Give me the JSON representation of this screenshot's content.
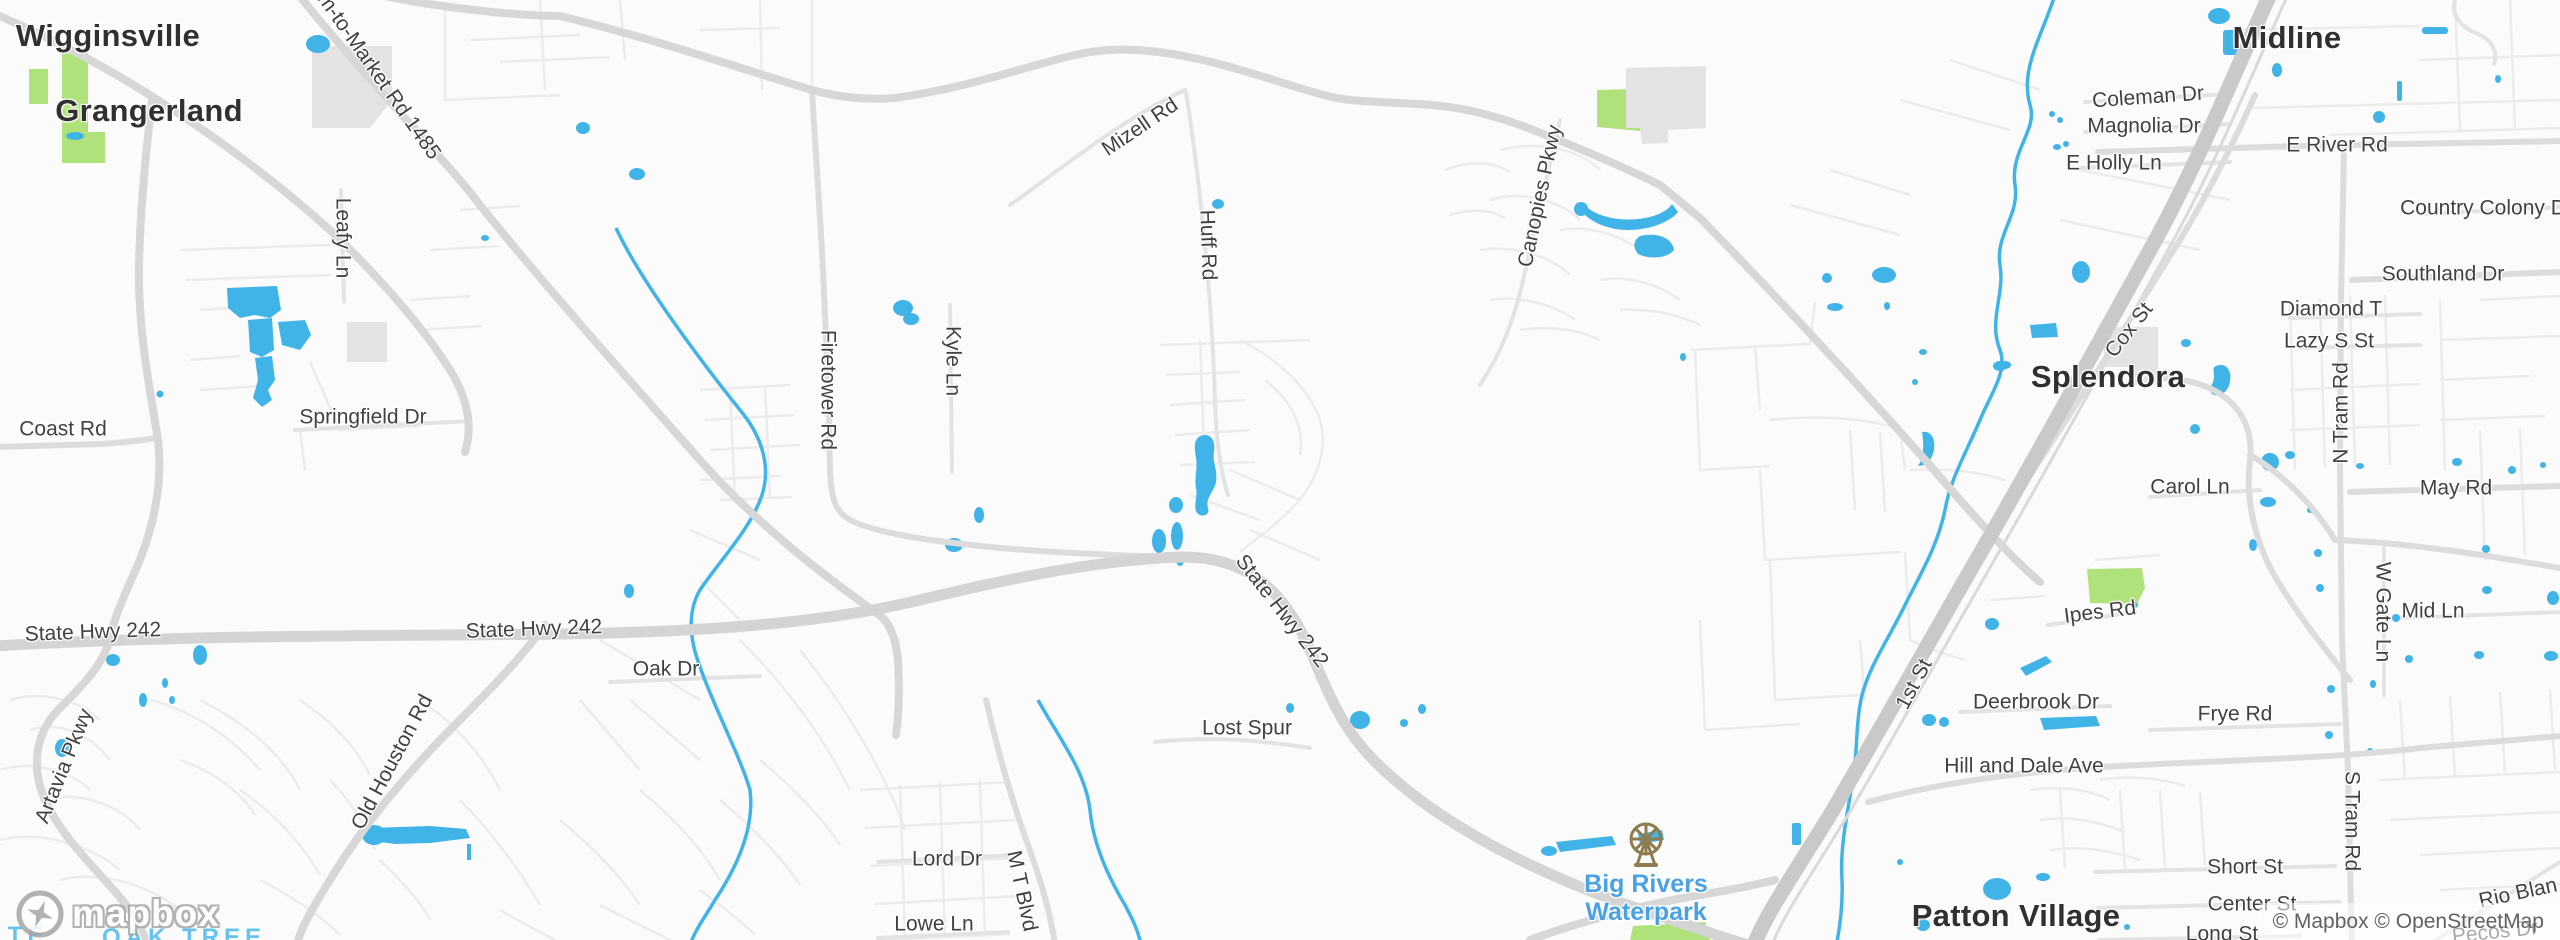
{
  "map": {
    "attribution": "© Mapbox © OpenStreetMap",
    "logo_text": "mapbox",
    "colors": {
      "background": "#fbfbfb",
      "water": "#41b4e7",
      "park_green": "#b0e27c",
      "building": "#e3e3e3",
      "road_major": "#d9d9d9",
      "road_highway": "#c9c9c9",
      "road_minor": "#e7e7e7",
      "town_label": "#303030",
      "road_label": "#414141",
      "poi_label": "#4aa1e4",
      "neighborhood_label": "#64c3f0",
      "attribution_text": "#616161"
    },
    "poi": {
      "line1": "Big Rivers",
      "line2": "Waterpark",
      "icon": "ferris-wheel-icon"
    },
    "labels": [
      {
        "text": "Wigginsville",
        "x": 108,
        "y": 36,
        "r": 0,
        "type": "city"
      },
      {
        "text": "Grangerland",
        "x": 149,
        "y": 111,
        "r": 0,
        "type": "city"
      },
      {
        "text": "Splendora",
        "x": 2108,
        "y": 377,
        "r": 0,
        "type": "city"
      },
      {
        "text": "Midline",
        "x": 2287,
        "y": 38,
        "r": 0,
        "type": "city"
      },
      {
        "text": "Patton Village",
        "x": 2016,
        "y": 916,
        "r": 0,
        "type": "city"
      },
      {
        "text": "Farm-to-Market Rd 1485",
        "x": 370,
        "y": 63,
        "r": 55,
        "type": "road"
      },
      {
        "text": "Coast Rd",
        "x": 63,
        "y": 429,
        "r": 0,
        "type": "road"
      },
      {
        "text": "State Hwy 242",
        "x": 93,
        "y": 632,
        "r": -2,
        "type": "road"
      },
      {
        "text": "State Hwy 242",
        "x": 534,
        "y": 629,
        "r": -2,
        "type": "road"
      },
      {
        "text": "State Hwy 242",
        "x": 1282,
        "y": 611,
        "r": 52,
        "type": "road"
      },
      {
        "text": "Oak Dr",
        "x": 666,
        "y": 669,
        "r": 0,
        "type": "road"
      },
      {
        "text": "Leafy Ln",
        "x": 343,
        "y": 238,
        "r": 90,
        "type": "road"
      },
      {
        "text": "Springfield Dr",
        "x": 363,
        "y": 417,
        "r": 0,
        "type": "road"
      },
      {
        "text": "Artavia Pkwy",
        "x": 64,
        "y": 766,
        "r": -68,
        "type": "road"
      },
      {
        "text": "Old Houston Rd",
        "x": 392,
        "y": 762,
        "r": -62,
        "type": "road"
      },
      {
        "text": "Firetower Rd",
        "x": 828,
        "y": 390,
        "r": 90,
        "type": "road"
      },
      {
        "text": "Kyle Ln",
        "x": 953,
        "y": 361,
        "r": 90,
        "type": "road"
      },
      {
        "text": "Mizell Rd",
        "x": 1140,
        "y": 127,
        "r": -34,
        "type": "road"
      },
      {
        "text": "Huff Rd",
        "x": 1208,
        "y": 245,
        "r": 88,
        "type": "road"
      },
      {
        "text": "Canopies Pkwy",
        "x": 1540,
        "y": 196,
        "r": -78,
        "type": "road"
      },
      {
        "text": "Lost Spur",
        "x": 1247,
        "y": 728,
        "r": 0,
        "type": "road"
      },
      {
        "text": "Lord Dr",
        "x": 947,
        "y": 859,
        "r": 0,
        "type": "road"
      },
      {
        "text": "Lowe Ln",
        "x": 934,
        "y": 924,
        "r": 0,
        "type": "road"
      },
      {
        "text": "M T Blvd",
        "x": 1022,
        "y": 891,
        "r": 78,
        "type": "road"
      },
      {
        "text": "1st St",
        "x": 1914,
        "y": 684,
        "r": -62,
        "type": "road"
      },
      {
        "text": "Coleman Dr",
        "x": 2148,
        "y": 97,
        "r": -4,
        "type": "road"
      },
      {
        "text": "Magnolia Dr",
        "x": 2144,
        "y": 126,
        "r": 0,
        "type": "road"
      },
      {
        "text": "E Holly Ln",
        "x": 2114,
        "y": 163,
        "r": 0,
        "type": "road"
      },
      {
        "text": "E River Rd",
        "x": 2337,
        "y": 145,
        "r": 0,
        "type": "road"
      },
      {
        "text": "Country Colony D",
        "x": 2483,
        "y": 208,
        "r": 0,
        "type": "road"
      },
      {
        "text": "Southland Dr",
        "x": 2443,
        "y": 274,
        "r": 0,
        "type": "road"
      },
      {
        "text": "Diamond T",
        "x": 2331,
        "y": 309,
        "r": 0,
        "type": "road"
      },
      {
        "text": "Lazy S St",
        "x": 2329,
        "y": 341,
        "r": 0,
        "type": "road"
      },
      {
        "text": "Cox St",
        "x": 2129,
        "y": 330,
        "r": -52,
        "type": "road"
      },
      {
        "text": "N Tram Rd",
        "x": 2341,
        "y": 413,
        "r": -90,
        "type": "road"
      },
      {
        "text": "Carol Ln",
        "x": 2190,
        "y": 487,
        "r": 0,
        "type": "road"
      },
      {
        "text": "May Rd",
        "x": 2456,
        "y": 488,
        "r": 0,
        "type": "road"
      },
      {
        "text": "Ipes Rd",
        "x": 2100,
        "y": 612,
        "r": -7,
        "type": "road"
      },
      {
        "text": "Mid Ln",
        "x": 2433,
        "y": 611,
        "r": 0,
        "type": "road"
      },
      {
        "text": "W Gate Ln",
        "x": 2383,
        "y": 612,
        "r": 90,
        "type": "road"
      },
      {
        "text": "Deerbrook Dr",
        "x": 2036,
        "y": 702,
        "r": 0,
        "type": "road"
      },
      {
        "text": "Frye Rd",
        "x": 2235,
        "y": 714,
        "r": 0,
        "type": "road"
      },
      {
        "text": "Hill and Dale Ave",
        "x": 2024,
        "y": 766,
        "r": 0,
        "type": "road"
      },
      {
        "text": "S Tram Rd",
        "x": 2352,
        "y": 821,
        "r": 90,
        "type": "road"
      },
      {
        "text": "Short St",
        "x": 2245,
        "y": 867,
        "r": 0,
        "type": "road"
      },
      {
        "text": "Center St",
        "x": 2252,
        "y": 904,
        "r": 0,
        "type": "road"
      },
      {
        "text": "Long St",
        "x": 2222,
        "y": 934,
        "r": 0,
        "type": "road"
      },
      {
        "text": "Rio Blan",
        "x": 2518,
        "y": 893,
        "r": -12,
        "type": "road"
      },
      {
        "text": "Pecos Dr",
        "x": 2495,
        "y": 932,
        "r": -6,
        "type": "road"
      },
      {
        "text": "OAK TREE",
        "x": 184,
        "y": 938,
        "r": 0,
        "type": "hood"
      },
      {
        "text": "TE",
        "x": 28,
        "y": 936,
        "r": 0,
        "type": "hood"
      }
    ]
  }
}
